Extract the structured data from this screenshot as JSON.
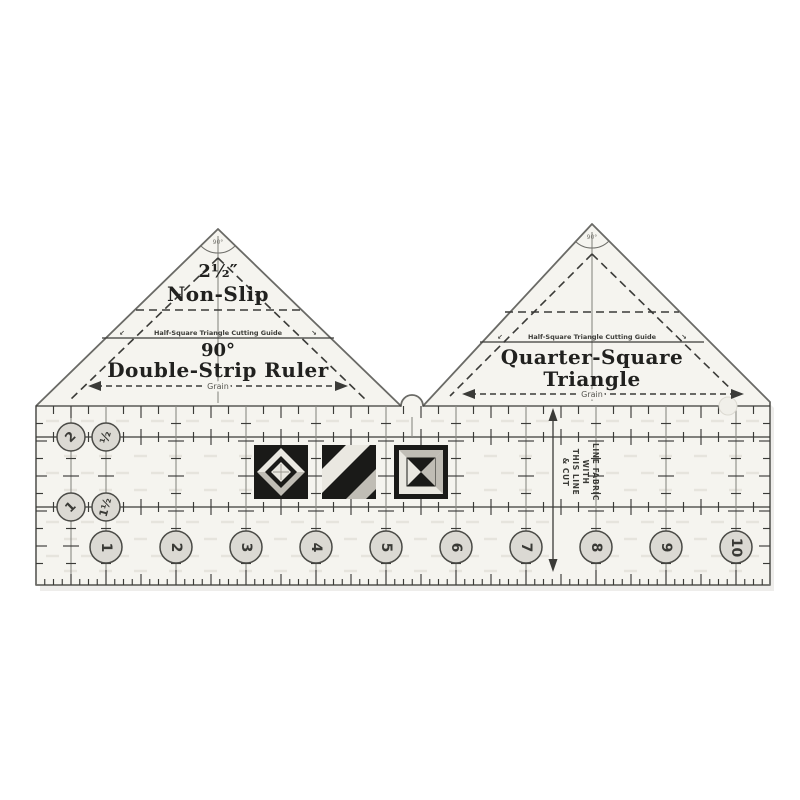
{
  "colors": {
    "background": "#ffffff",
    "body": "#f5f4ef",
    "ink": "#3b3b38",
    "circle_fill": "#dbd9d3",
    "grip_dash": "#e6e4dd",
    "block_black": "#1a1a18",
    "block_light": "#eae8e1",
    "block_gray": "#c0bdb5"
  },
  "left_triangle": {
    "size": "2½″",
    "nonslip": "Non-Slip",
    "guide": "Half-Square Triangle Cutting Guide",
    "angle": "90°",
    "title": "Double-Strip Ruler",
    "grain": "Grain",
    "apex_angle": "90°"
  },
  "right_triangle": {
    "guide": "Half-Square Triangle Cutting Guide",
    "title_line1": "Quarter-Square",
    "title_line2": "Triangle",
    "grain": "Grain",
    "apex_angle": "90°"
  },
  "base": {
    "inch_labels": [
      "1",
      "2",
      "3",
      "4",
      "5",
      "6",
      "7",
      "8",
      "9",
      "10"
    ],
    "strip_row_top": [
      "2",
      "½"
    ],
    "strip_row_bottom": [
      "1",
      "1½"
    ],
    "note_lines": [
      "LINE FABRIC",
      "WITH",
      "THIS LINE",
      "& CUT"
    ]
  },
  "icons": {
    "guide_arrow_left": "↙",
    "guide_arrow_right": "↘"
  }
}
